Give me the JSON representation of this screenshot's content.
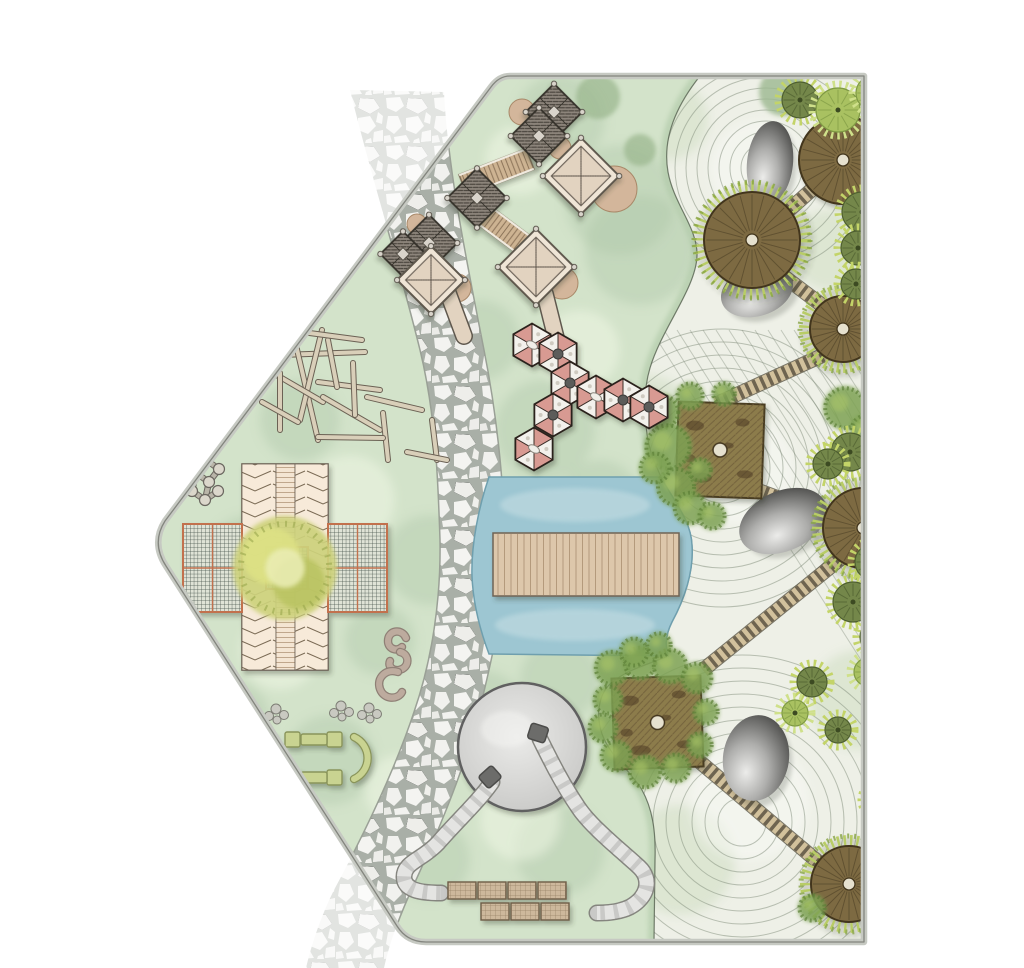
{
  "canvas": {
    "width": 1024,
    "height": 968
  },
  "palette": {
    "lawn": "#d3e3ca",
    "lawn_dark": "#a8c4a4",
    "lawn_light": "#eef5e4",
    "gravel": "#eef0e7",
    "contour": "#7f8b7a",
    "zen_wash": "#c2d6b4",
    "zen_light": "#f7f8f3",
    "stone": "#f3f3f0",
    "grout": "#a9afa7",
    "band_edge": "#9aa096",
    "water": "#9dc6d2",
    "water_edge": "#6f9fae",
    "water_light": "#cbe1e5",
    "bridge": "#ddc7ab",
    "bridge_line": "#a88d6d",
    "bridge_edge": "#6f6454",
    "deck": "#84744a",
    "deck_line": "#65542f",
    "deck_rim": "#42351e",
    "deck_hole": "#e6e1cf",
    "ladder_light": "#d2c19c",
    "ladder_dark": "#6e6450",
    "ladder_under": "#4f4a3a",
    "tree_olive": "#74874a",
    "tree_olive_line": "#4e5f30",
    "tree_fringe": "#c3d468",
    "tree_light": "#a9c161",
    "tree_light_line": "#7f9a44",
    "soft_tree": "#9cb890",
    "bush": "#7da152",
    "bush_dark": "#5d8038",
    "boulder_light": "#e8e8e6",
    "boulder_mid": "#8f8f8d",
    "boulder_dark": "#4b4b49",
    "hex_pink": "#d89a92",
    "hex_white": "#f3f1ec",
    "hex_line": "#3a2d28",
    "hex_port": "#5c5c5a",
    "hatch_fill": "#8d857b",
    "hatch_line": "#3f3a33",
    "tower_line": "#34302a",
    "cream": "#efe5d6",
    "cream_inner": "#e2d3c0",
    "cream_line": "#5f584e",
    "ramp": "#cdb392",
    "ramp_line": "#8a7258",
    "tan": "#d3b69b",
    "tube": "#c9c9c7",
    "tube_light": "#e4e4e2",
    "tube_under": "#85857f",
    "tube_cap": "#6c6c6a",
    "mound_in": "#eaeae8",
    "mound_out": "#c6c6c4",
    "mound_line": "#606060",
    "mat": "#cdb89c",
    "mat_line": "#8a7458",
    "chevron_bg": "#f7ead9",
    "chevron_line": "#7a6a54",
    "hlines_bg": "#f4e5d2",
    "hlines_line": "#c0a78c",
    "mesh_bg": "#dfe3d6",
    "mesh_line": "#45524a",
    "mesh_border": "#c2714e",
    "canopy": "#cdd27b",
    "canopy_dark": "#b8c25f",
    "canopy_light": "#e9ecb2",
    "canopy_ring": "#99a64c",
    "stick": "#d9cfb9",
    "stick_line": "#6b6154",
    "bench": "#c9d391",
    "bench_line": "#89945a",
    "molecule": "#dbd7cb",
    "molecule_line": "#6a665f",
    "molecule_bar": "#b9b5a8",
    "pebble": "#c9c9c1",
    "pebble_line": "#7d7d75",
    "border_band": "#c6c9c2",
    "border_line": "#83857e",
    "squiggle": "#bdab9e",
    "squiggle_dark": "#8f8076"
  },
  "site": {
    "path": "M 510 76 L 864 76 L 864 942 L 426 942 Q 407 942 397 926 L 166 566 Q 151 543 165 521 L 491 87 Q 499 76 510 76 Z"
  },
  "flagstone": {
    "band_path": "M 350 90 C 372 180 398 260 420 350 C 436 416 438 480 440 540 C 441 600 432 660 414 712 C 394 772 362 838 334 890 C 322 914 312 942 306 968 L 384 968 C 390 940 402 910 416 880 C 436 836 462 776 478 716 C 492 660 506 600 505 545 C 504 480 496 410 484 350 C 466 258 448 170 444 92 Z"
  },
  "zen": {
    "path": "M 700 76 C 676 106 662 138 668 172 C 674 205 698 228 697 256 C 696 288 662 328 650 368 C 642 394 644 430 652 456 L 661 477 C 673 500 691 520 692 545 C 694 572 684 600 672 622 C 664 638 666 648 668 656 C 654 663 628 668 610 684 C 598 696 596 716 602 734 C 610 756 630 770 642 790 C 652 808 656 830 655 860 L 654 942 L 864 942 L 864 76 Z",
    "edge": "M 700 76 C 676 106 662 138 668 172 C 674 205 698 228 697 256 C 696 288 662 328 650 368 C 642 394 644 430 652 456 L 661 477 C 673 500 691 520 692 545 C 694 572 684 600 672 622 C 664 638 666 648 668 656 C 654 663 628 668 610 684 C 598 696 596 716 602 734 C 610 756 630 770 642 790 C 652 808 656 830 655 860 L 654 942",
    "contours": [
      {
        "cx": 766,
        "cy": 168,
        "r0": 14,
        "r1": 112,
        "step": 11
      },
      {
        "cx": 722,
        "cy": 468,
        "r0": 22,
        "r1": 150,
        "step": 13
      },
      {
        "cx": 742,
        "cy": 822,
        "r0": 24,
        "r1": 175,
        "step": 13
      }
    ],
    "diagonals": {
      "x0": 690,
      "y0": 330,
      "dx": 210,
      "dy": 330,
      "n": 15,
      "i0": -3,
      "sx": 13
    },
    "boulders": [
      {
        "cx": 770,
        "cy": 163,
        "rx": 23,
        "ry": 42,
        "rot": 6
      },
      {
        "cx": 757,
        "cy": 291,
        "rx": 37,
        "ry": 25,
        "rot": -18
      },
      {
        "cx": 783,
        "cy": 521,
        "rx": 46,
        "ry": 30,
        "rot": -24
      },
      {
        "cx": 756,
        "cy": 758,
        "rx": 33,
        "ry": 43,
        "rot": 8
      }
    ],
    "round_decks": [
      {
        "cx": 843,
        "cy": 160,
        "r": 44,
        "fringe": false
      },
      {
        "cx": 752,
        "cy": 240,
        "r": 48,
        "fringe": true
      },
      {
        "cx": 843,
        "cy": 329,
        "r": 33,
        "fringe": true
      },
      {
        "cx": 863,
        "cy": 528,
        "r": 40,
        "fringe": true
      },
      {
        "cx": 849,
        "cy": 884,
        "r": 38,
        "fringe": true
      }
    ],
    "square_decks": [
      {
        "x": 677,
        "y": 403,
        "w": 86,
        "h": 94,
        "rot": 2
      },
      {
        "x": 613,
        "y": 677,
        "w": 89,
        "h": 91,
        "rot": -2
      }
    ],
    "ladders": [
      [
        827,
        176,
        779,
        219
      ],
      [
        770,
        266,
        823,
        306
      ],
      [
        830,
        352,
        716,
        404
      ],
      [
        757,
        490,
        838,
        520
      ],
      [
        845,
        555,
        703,
        670
      ],
      [
        700,
        762,
        830,
        872
      ]
    ],
    "trees_dark": [
      [
        800,
        100,
        18
      ],
      [
        862,
        212,
        20
      ],
      [
        858,
        248,
        17
      ],
      [
        856,
        284,
        15
      ],
      [
        884,
        238,
        16
      ],
      [
        850,
        452,
        19
      ],
      [
        828,
        464,
        15
      ],
      [
        873,
        562,
        18
      ],
      [
        853,
        602,
        20
      ],
      [
        877,
        637,
        17
      ],
      [
        812,
        682,
        15
      ],
      [
        880,
        800,
        15
      ],
      [
        838,
        730,
        13
      ]
    ],
    "trees_light": [
      [
        838,
        110,
        22
      ],
      [
        873,
        93,
        17
      ],
      [
        795,
        713,
        13
      ],
      [
        868,
        672,
        14
      ]
    ],
    "soft_trees": [
      [
        783,
        92,
        24
      ]
    ],
    "bushes": [
      [
        662,
        412,
        18
      ],
      [
        668,
        447,
        24
      ],
      [
        676,
        487,
        20
      ],
      [
        690,
        508,
        17
      ],
      [
        712,
        516,
        14
      ],
      [
        690,
        396,
        14
      ],
      [
        724,
        394,
        12
      ],
      [
        655,
        468,
        16
      ],
      [
        700,
        470,
        12
      ],
      [
        612,
        668,
        18
      ],
      [
        640,
        663,
        17
      ],
      [
        670,
        666,
        18
      ],
      [
        697,
        678,
        16
      ],
      [
        608,
        700,
        15
      ],
      [
        603,
        728,
        15
      ],
      [
        616,
        756,
        16
      ],
      [
        645,
        772,
        17
      ],
      [
        676,
        768,
        15
      ],
      [
        700,
        745,
        13
      ],
      [
        706,
        712,
        13
      ],
      [
        634,
        652,
        15
      ],
      [
        659,
        645,
        13
      ],
      [
        884,
        246,
        16
      ],
      [
        845,
        408,
        22
      ],
      [
        866,
        430,
        16
      ],
      [
        884,
        130,
        14
      ],
      [
        884,
        852,
        16
      ],
      [
        812,
        908,
        14
      ],
      [
        882,
        908,
        16
      ]
    ]
  },
  "water": {
    "path": "M 489 477 L 661 477 C 673 500 691 520 692 545 C 694 572 684 600 672 622 C 664 638 666 648 668 656 L 489 654 C 480 630 473 602 472 576 C 471 544 479 506 489 477 Z",
    "bridge": {
      "x": 493,
      "y": 533,
      "w": 186,
      "h": 63
    }
  },
  "tower": {
    "tan_circles": [
      [
        522,
        112,
        13
      ],
      [
        614,
        189,
        23
      ],
      [
        560,
        148,
        11
      ],
      [
        562,
        283,
        16
      ],
      [
        457,
        288,
        14
      ],
      [
        417,
        224,
        10
      ]
    ],
    "diamonds": [
      [
        554,
        112,
        40
      ],
      [
        539,
        136,
        40
      ],
      [
        477,
        198,
        42
      ],
      [
        429,
        243,
        40
      ],
      [
        403,
        254,
        32
      ]
    ],
    "ramps": [
      [
        463,
        185,
        530,
        159
      ],
      [
        484,
        215,
        524,
        245
      ]
    ],
    "pavilions": [
      [
        581,
        176,
        54
      ],
      [
        536,
        267,
        54
      ],
      [
        431,
        280,
        48
      ]
    ],
    "slides": [
      [
        545,
        294,
        556,
        338
      ],
      [
        448,
        293,
        464,
        336
      ]
    ]
  },
  "hexes": {
    "r": 21.5,
    "items": [
      {
        "x": 532,
        "y": 345,
        "c": false
      },
      {
        "x": 558,
        "y": 354,
        "c": true
      },
      {
        "x": 570,
        "y": 383,
        "c": true
      },
      {
        "x": 596,
        "y": 397,
        "c": false
      },
      {
        "x": 623,
        "y": 400,
        "c": true
      },
      {
        "x": 649,
        "y": 407,
        "c": true
      },
      {
        "x": 553,
        "y": 415,
        "c": true
      },
      {
        "x": 534,
        "y": 449,
        "c": false
      }
    ]
  },
  "mound": {
    "cx": 522,
    "cy": 747,
    "r": 64
  },
  "tubes": [
    "M 492 782 C 478 802 458 820 438 843 C 422 860 404 862 404 877 C 404 890 420 893 441 893",
    "M 540 739 C 549 757 561 782 578 807 C 591 827 623 852 639 867 C 652 879 648 897 630 907 C 620 912 606 913 597 913"
  ],
  "tube_caps": [
    {
      "x": 490,
      "y": 777,
      "rot": -42
    },
    {
      "x": 538,
      "y": 733,
      "rot": 18
    }
  ],
  "mats": {
    "w": 28,
    "h": 17,
    "rows": [
      {
        "y": 882,
        "xs": [
          448,
          478,
          508,
          538
        ]
      },
      {
        "y": 903,
        "xs": [
          481,
          511,
          541
        ]
      }
    ]
  },
  "sticks": [
    [
      280,
      355,
      365,
      352
    ],
    [
      296,
      345,
      318,
      440
    ],
    [
      322,
      330,
      300,
      420
    ],
    [
      268,
      370,
      323,
      402
    ],
    [
      280,
      373,
      280,
      430
    ],
    [
      318,
      382,
      380,
      390
    ],
    [
      323,
      397,
      380,
      430
    ],
    [
      328,
      340,
      337,
      387
    ],
    [
      353,
      363,
      355,
      415
    ],
    [
      367,
      397,
      422,
      410
    ],
    [
      383,
      413,
      388,
      460
    ],
    [
      318,
      437,
      383,
      438
    ],
    [
      432,
      420,
      437,
      460
    ],
    [
      407,
      452,
      447,
      460
    ],
    [
      262,
      402,
      298,
      422
    ],
    [
      302,
      332,
      362,
      340
    ]
  ],
  "building": {
    "vx": 242,
    "vy": 464,
    "vw": 86,
    "vh": 206,
    "colw": [
      34,
      19,
      33
    ],
    "arms": [
      {
        "x": 183,
        "y": 524
      },
      {
        "x": 328,
        "y": 524
      }
    ],
    "aw": 59,
    "ah": 88,
    "center": {
      "x": 266,
      "y": 547,
      "s": 42
    },
    "canopy": {
      "cx": 285,
      "cy": 568,
      "r": 52
    }
  },
  "molecules": [
    {
      "nodes": [
        [
          206,
          460
        ],
        [
          219,
          469
        ],
        [
          196,
          473
        ],
        [
          209,
          482
        ],
        [
          192,
          491
        ],
        [
          205,
          500
        ],
        [
          218,
          491
        ]
      ],
      "links": [
        [
          0,
          1
        ],
        [
          0,
          2
        ],
        [
          2,
          3
        ],
        [
          1,
          3
        ],
        [
          3,
          5
        ],
        [
          4,
          5
        ],
        [
          5,
          6
        ],
        [
          2,
          4
        ]
      ]
    },
    {
      "nodes": [
        [
          199,
          640
        ],
        [
          212,
          647
        ],
        [
          193,
          654
        ],
        [
          206,
          661
        ],
        [
          198,
          672
        ],
        [
          212,
          668
        ]
      ],
      "links": [
        [
          0,
          1
        ],
        [
          0,
          2
        ],
        [
          2,
          3
        ],
        [
          1,
          3
        ],
        [
          3,
          5
        ],
        [
          2,
          4
        ],
        [
          4,
          5
        ]
      ]
    }
  ],
  "squiggle": [
    "M 406 638 C 402 628 388 630 388 641 C 388 649 397 652 402 647",
    "M 400 652 C 410 654 410 668 399 670 C 392 671 388 666 390 661",
    "M 398 672 C 386 668 376 678 380 689 C 384 700 398 700 402 692"
  ],
  "pebbles": {
    "groups": [
      [
        247,
        712
      ],
      [
        276,
        714
      ],
      [
        341,
        711
      ],
      [
        369,
        713
      ]
    ],
    "offsets": [
      [
        0,
        -5
      ],
      [
        8,
        1
      ],
      [
        -7,
        2
      ],
      [
        1,
        6
      ]
    ],
    "radii": [
      5,
      4.5,
      4.5,
      4
    ]
  },
  "seating": {
    "arcs": [
      "M 272 737 A 23 23 0 0 0 272 779",
      "M 354 737 A 23 23 0 0 1 354 779"
    ],
    "squares": [
      [
        285,
        732
      ],
      [
        327,
        732
      ],
      [
        285,
        770
      ],
      [
        327,
        770
      ]
    ],
    "sq": 15,
    "rects": [
      [
        301,
        734
      ],
      [
        301,
        772
      ]
    ],
    "rw": 26,
    "rh": 11
  },
  "washes": {
    "lawn_dark": [
      [
        560,
        120,
        45
      ],
      [
        620,
        200,
        55
      ],
      [
        480,
        340,
        40
      ],
      [
        545,
        430,
        50
      ],
      [
        430,
        560,
        45
      ],
      [
        300,
        420,
        40
      ],
      [
        250,
        560,
        45
      ],
      [
        230,
        720,
        40
      ],
      [
        330,
        760,
        45
      ],
      [
        480,
        720,
        50
      ],
      [
        560,
        680,
        40
      ],
      [
        430,
        860,
        40
      ],
      [
        560,
        850,
        45
      ],
      [
        640,
        250,
        55
      ],
      [
        600,
        500,
        40
      ],
      [
        380,
        640,
        35
      ]
    ],
    "lawn_light": [
      [
        520,
        160,
        35
      ],
      [
        580,
        350,
        40
      ],
      [
        350,
        500,
        45
      ],
      [
        280,
        650,
        40
      ],
      [
        500,
        600,
        40
      ],
      [
        400,
        790,
        35
      ],
      [
        520,
        820,
        40
      ]
    ],
    "zen_green": [
      [
        668,
        120,
        40
      ],
      [
        648,
        420,
        45
      ],
      [
        625,
        700,
        50
      ],
      [
        680,
        860,
        55
      ],
      [
        860,
        700,
        50
      ],
      [
        830,
        250,
        40
      ]
    ],
    "zen_light": [
      [
        760,
        170,
        50
      ],
      [
        740,
        470,
        55
      ],
      [
        750,
        800,
        60
      ]
    ]
  },
  "soft_trees_lawn": [
    [
      598,
      97,
      22
    ],
    [
      640,
      150,
      16
    ]
  ]
}
